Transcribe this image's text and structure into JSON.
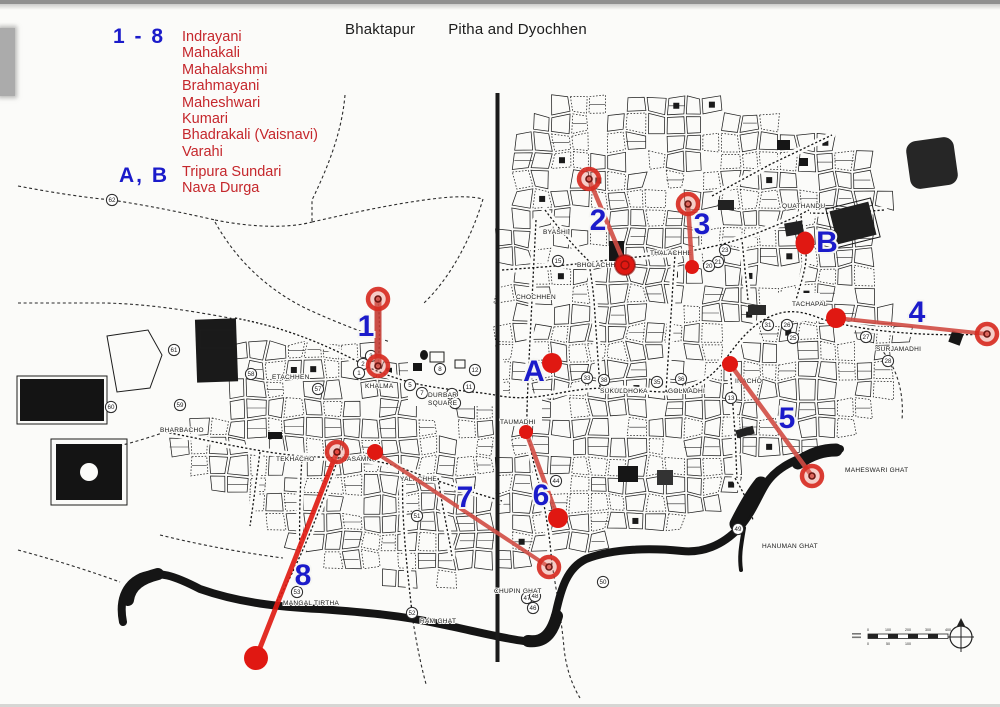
{
  "title": {
    "city": "Bhaktapur",
    "subject": "Pitha and Dyochhen"
  },
  "legend": {
    "group1": {
      "key": "1 - 8",
      "items": [
        "Indrayani",
        "Mahakali",
        "Mahalakshmi",
        "Brahmayani",
        "Maheshwari",
        "Kumari",
        "Bhadrakali (Vaisnavi)",
        "Varahi"
      ]
    },
    "group2": {
      "key": "A, B",
      "items": [
        "Tripura Sundari",
        "Nava Durga"
      ]
    }
  },
  "colors": {
    "marker_red": "#e01812",
    "line_red": "#d14c44",
    "label_blue": "#1b1bca",
    "legend_red": "#c5272c",
    "map_ink": "#1c1c1c"
  },
  "markers": [
    {
      "label": "1",
      "lx": 366,
      "ly": 336,
      "line": [
        378,
        299,
        378,
        366
      ],
      "lc": "#c53c34",
      "lw": 7,
      "ends": [
        {
          "t": "ring"
        },
        {
          "t": "ring"
        }
      ]
    },
    {
      "label": "2",
      "lx": 598,
      "ly": 230,
      "line": [
        589,
        179,
        625,
        265
      ],
      "lw": 4.5,
      "ends": [
        {
          "t": "ring"
        },
        {
          "t": "dotring",
          "r": 10
        }
      ]
    },
    {
      "label": "3",
      "lx": 702,
      "ly": 234,
      "line": [
        688,
        204,
        692,
        267
      ],
      "lw": 4.5,
      "ends": [
        {
          "t": "ring"
        },
        {
          "t": "dot",
          "r": 7
        }
      ]
    },
    {
      "label": "4",
      "lx": 917,
      "ly": 322,
      "line": [
        836,
        318,
        987,
        334
      ],
      "lw": 4,
      "ends": [
        {
          "t": "dot",
          "r": 10
        },
        {
          "t": "ring"
        }
      ]
    },
    {
      "label": "5",
      "lx": 787,
      "ly": 428,
      "line": [
        730,
        364,
        812,
        476
      ],
      "lw": 4.5,
      "ends": [
        {
          "t": "dot",
          "r": 8
        },
        {
          "t": "ring"
        }
      ]
    },
    {
      "label": "6",
      "lx": 541,
      "ly": 505,
      "line": [
        526,
        432,
        558,
        518
      ],
      "lw": 4.5,
      "ends": [
        {
          "t": "dot",
          "r": 7
        },
        {
          "t": "dot",
          "r": 10
        }
      ]
    },
    {
      "label": "7",
      "lx": 465,
      "ly": 507,
      "line": [
        375,
        452,
        549,
        567
      ],
      "lw": 4,
      "ends": [
        {
          "t": "dot",
          "r": 8
        },
        {
          "t": "ring"
        }
      ]
    },
    {
      "label": "8",
      "lx": 303,
      "ly": 585,
      "line": [
        337,
        452,
        256,
        658
      ],
      "lc": "#e01810",
      "lw": 5,
      "ends": [
        {
          "t": "ring"
        },
        {
          "t": "dot",
          "r": 12
        }
      ]
    },
    {
      "label": "A",
      "lx": 534,
      "ly": 381,
      "point": [
        552,
        363
      ],
      "r": 10
    },
    {
      "label": "B",
      "lx": 827,
      "ly": 252,
      "point": [
        805,
        243
      ],
      "r": 9.5,
      "ry": 11.5
    }
  ],
  "place_labels": [
    {
      "text": "ETACHHEN",
      "x": 272,
      "y": 379
    },
    {
      "text": "KHALMA",
      "x": 365,
      "y": 388
    },
    {
      "text": "DURBAR",
      "x": 428,
      "y": 397
    },
    {
      "text": "SQUARE",
      "x": 428,
      "y": 405
    },
    {
      "text": "BHARBACHO",
      "x": 160,
      "y": 432
    },
    {
      "text": "TEKHACHO",
      "x": 276,
      "y": 461
    },
    {
      "text": "NASAMNA",
      "x": 342,
      "y": 461
    },
    {
      "text": "YALACHHE",
      "x": 400,
      "y": 481
    },
    {
      "text": "BYASHI",
      "x": 543,
      "y": 234
    },
    {
      "text": "CHOCHHEN",
      "x": 516,
      "y": 299
    },
    {
      "text": "BHOLACHHE",
      "x": 577,
      "y": 267
    },
    {
      "text": "THALACHHE",
      "x": 650,
      "y": 255
    },
    {
      "text": "QUATHANDU",
      "x": 782,
      "y": 208
    },
    {
      "text": "TACHAPAL",
      "x": 792,
      "y": 306
    },
    {
      "text": "SURJAMADHI",
      "x": 876,
      "y": 351
    },
    {
      "text": "SUKULDHOKA",
      "x": 600,
      "y": 393
    },
    {
      "text": "GOLMADHI",
      "x": 668,
      "y": 393
    },
    {
      "text": "TAUMADHI",
      "x": 500,
      "y": 424
    },
    {
      "text": "INACHO",
      "x": 735,
      "y": 383
    },
    {
      "text": "MANGAL TIRTHA",
      "x": 283,
      "y": 605
    },
    {
      "text": "RAM GHAT",
      "x": 420,
      "y": 623
    },
    {
      "text": "CHUPIN GHAT",
      "x": 494,
      "y": 593
    },
    {
      "text": "HANUMAN GHAT",
      "x": 762,
      "y": 548
    },
    {
      "text": "MAHESWARI GHAT",
      "x": 845,
      "y": 472
    }
  ],
  "circled_numbers": [
    {
      "n": "62",
      "x": 112,
      "y": 200
    },
    {
      "n": "61",
      "x": 174,
      "y": 350
    },
    {
      "n": "60",
      "x": 111,
      "y": 407
    },
    {
      "n": "59",
      "x": 180,
      "y": 405
    },
    {
      "n": "58",
      "x": 251,
      "y": 374
    },
    {
      "n": "57",
      "x": 318,
      "y": 389
    },
    {
      "n": "3",
      "x": 371,
      "y": 356
    },
    {
      "n": "2",
      "x": 363,
      "y": 364
    },
    {
      "n": "1",
      "x": 359,
      "y": 373
    },
    {
      "n": "5",
      "x": 410,
      "y": 385
    },
    {
      "n": "7",
      "x": 422,
      "y": 393
    },
    {
      "n": "8",
      "x": 440,
      "y": 369
    },
    {
      "n": "10",
      "x": 452,
      "y": 394
    },
    {
      "n": "9",
      "x": 455,
      "y": 403
    },
    {
      "n": "11",
      "x": 469,
      "y": 387
    },
    {
      "n": "12",
      "x": 475,
      "y": 370
    },
    {
      "n": "15",
      "x": 558,
      "y": 261
    },
    {
      "n": "23",
      "x": 725,
      "y": 250
    },
    {
      "n": "21",
      "x": 718,
      "y": 262
    },
    {
      "n": "20",
      "x": 709,
      "y": 266
    },
    {
      "n": "31",
      "x": 768,
      "y": 325
    },
    {
      "n": "26",
      "x": 787,
      "y": 325
    },
    {
      "n": "25",
      "x": 793,
      "y": 338
    },
    {
      "n": "27",
      "x": 866,
      "y": 337
    },
    {
      "n": "28",
      "x": 888,
      "y": 361
    },
    {
      "n": "33",
      "x": 587,
      "y": 378
    },
    {
      "n": "38",
      "x": 604,
      "y": 380
    },
    {
      "n": "35",
      "x": 657,
      "y": 382
    },
    {
      "n": "36",
      "x": 681,
      "y": 379
    },
    {
      "n": "13",
      "x": 731,
      "y": 398
    },
    {
      "n": "44",
      "x": 556,
      "y": 481
    },
    {
      "n": "51",
      "x": 417,
      "y": 516
    },
    {
      "n": "52",
      "x": 412,
      "y": 613
    },
    {
      "n": "53",
      "x": 297,
      "y": 592
    },
    {
      "n": "47",
      "x": 527,
      "y": 598
    },
    {
      "n": "48",
      "x": 535,
      "y": 596
    },
    {
      "n": "46",
      "x": 533,
      "y": 608
    },
    {
      "n": "50",
      "x": 603,
      "y": 582
    },
    {
      "n": "49",
      "x": 738,
      "y": 529
    }
  ],
  "scale_bar": {
    "top_ticks": [
      "0",
      "100",
      "200",
      "300",
      "400"
    ],
    "bottom_ticks": [
      "0",
      "50",
      "100"
    ]
  }
}
